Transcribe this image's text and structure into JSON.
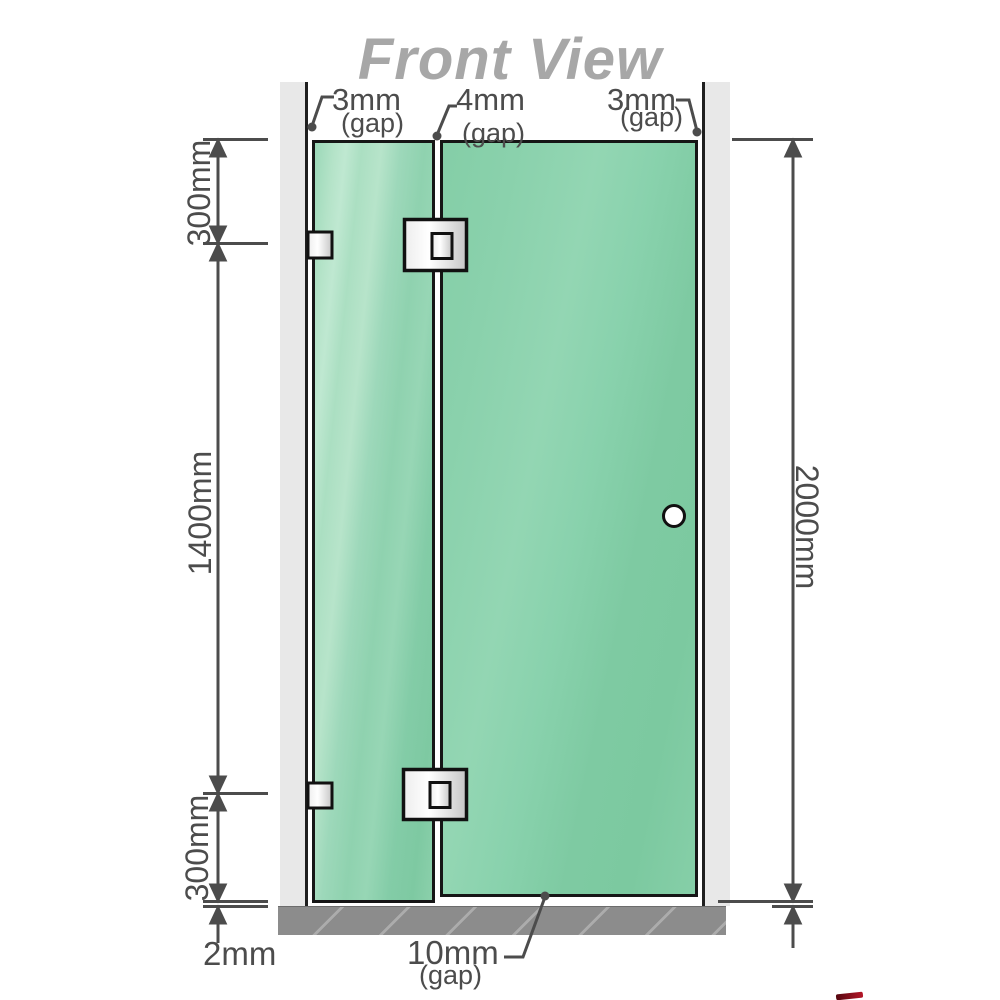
{
  "title": "Front View",
  "annotations": {
    "top_left_gap": {
      "value": "3mm",
      "note": "(gap)"
    },
    "top_middle_gap": {
      "value": "4mm",
      "note": "(gap)"
    },
    "top_right_gap": {
      "value": "3mm",
      "note": "(gap)"
    },
    "left_upper_segment": "300mm",
    "left_middle_segment": "1400mm",
    "left_lower_segment": "300mm",
    "total_height": "2000mm",
    "bottom_floor_gap": "2mm",
    "bottom_door_gap": {
      "value": "10mm",
      "note": "(gap)"
    }
  },
  "colors": {
    "glass_green": "#86cea8",
    "wall_gray": "#e8e8e8",
    "floor_gray": "#8c8c8c",
    "dimension_gray": "#4c4c4c",
    "title_gray": "#a7a7a7",
    "outline_black": "#161616"
  }
}
